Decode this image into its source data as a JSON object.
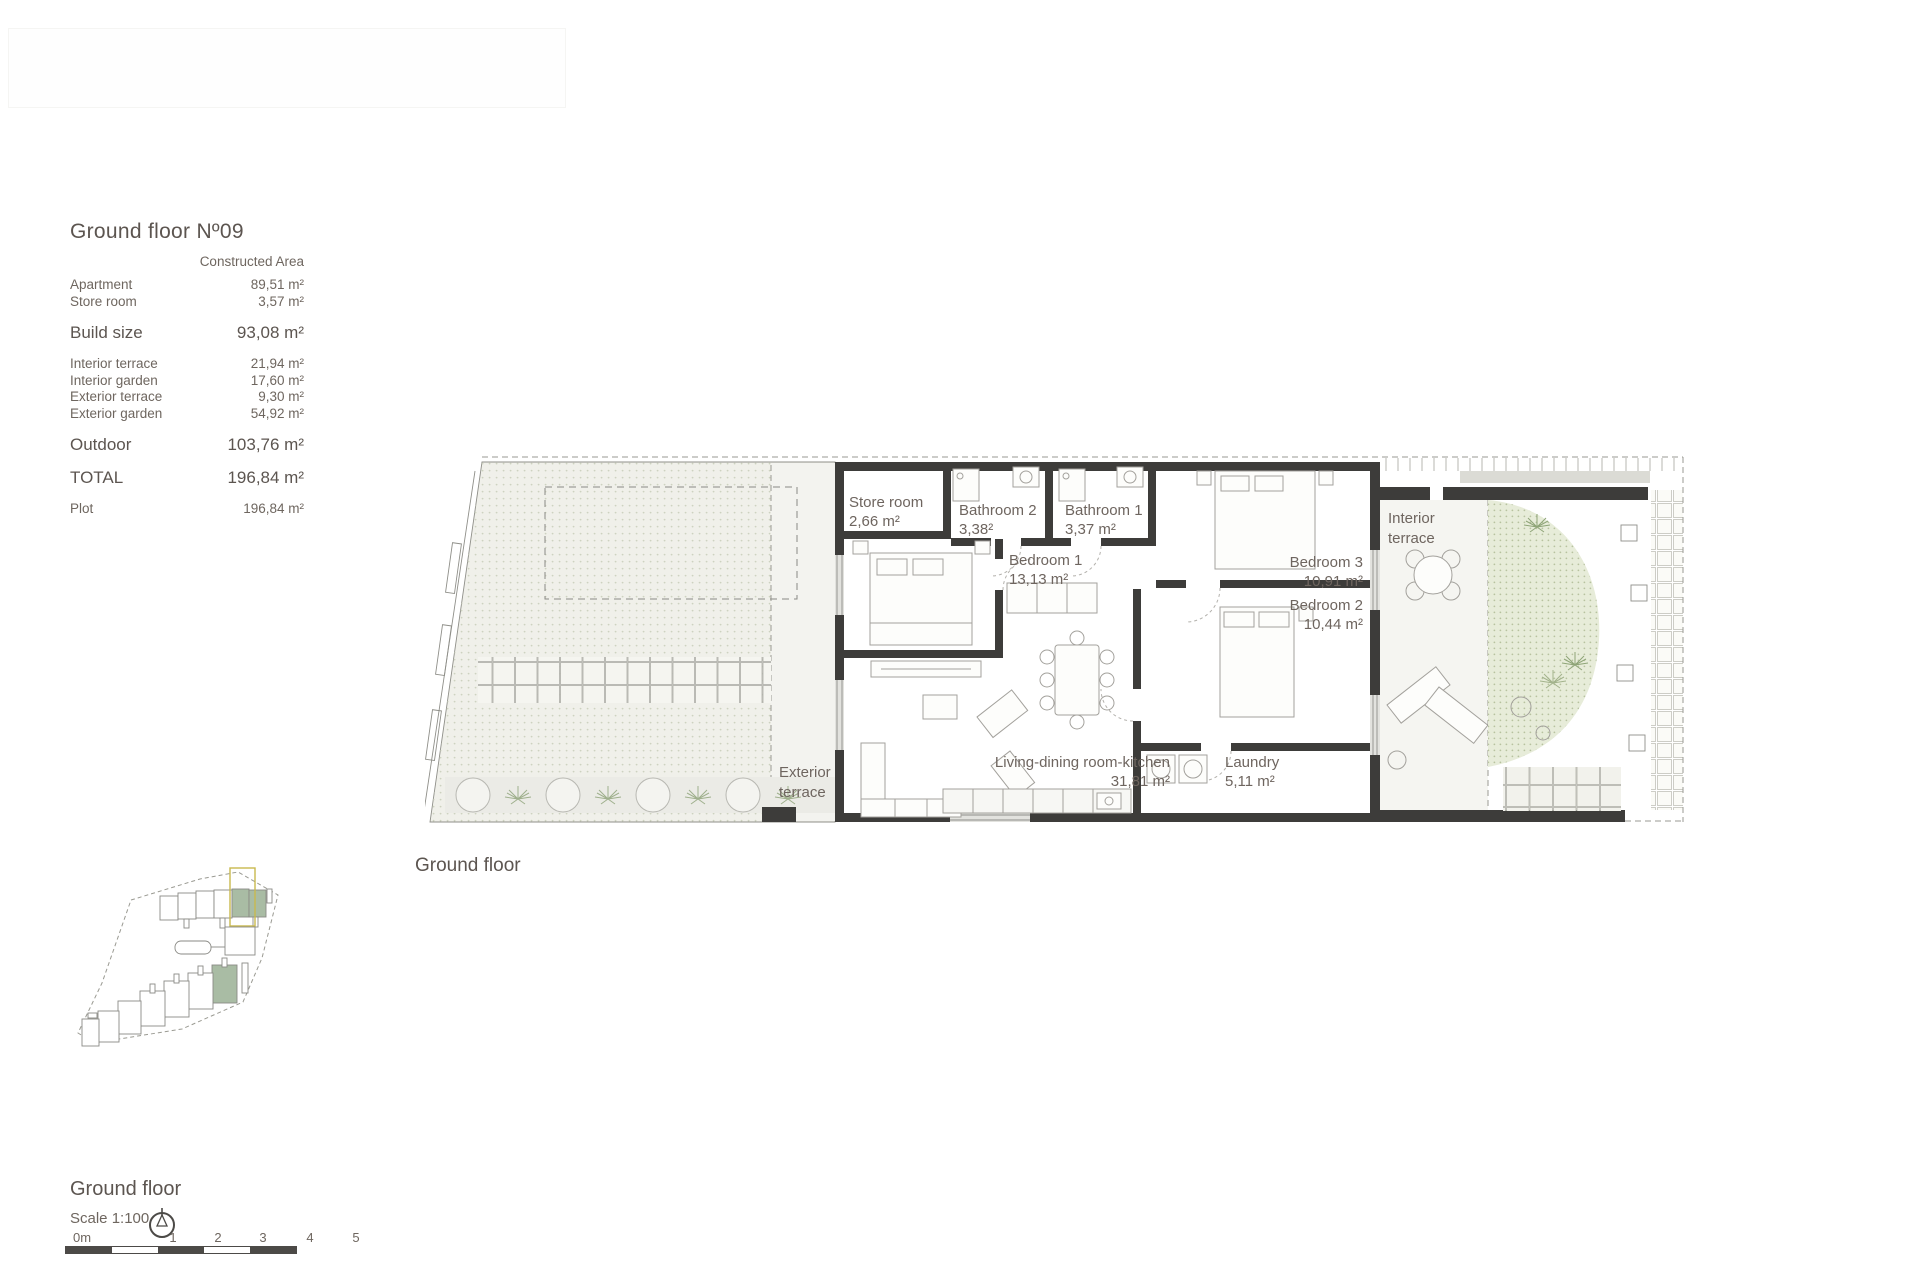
{
  "area_table": {
    "title": "Ground floor Nº09",
    "column_header": "Constructed Area",
    "rows": [
      {
        "label": "Apartment",
        "value": "89,51 m²"
      },
      {
        "label": "Store room",
        "value": "3,57 m²"
      },
      {
        "label": "Build size",
        "value": "93,08 m²"
      },
      {
        "label": "Interior terrace",
        "value": "21,94 m²"
      },
      {
        "label": "Interior garden",
        "value": "17,60 m²"
      },
      {
        "label": "Exterior terrace",
        "value": "9,30 m²"
      },
      {
        "label": "Exterior garden",
        "value": "54,92 m²"
      },
      {
        "label": "Outdoor",
        "value": "103,76 m²"
      },
      {
        "label": "TOTAL",
        "value": "196,84 m²"
      },
      {
        "label": "Plot",
        "value": "196,84 m²"
      }
    ]
  },
  "floor_plan": {
    "caption": "Ground floor",
    "labels": {
      "store_room": {
        "name": "Store room",
        "area": "2,66 m²"
      },
      "bathroom2": {
        "name": "Bathroom 2",
        "area": "3,38²"
      },
      "bathroom1": {
        "name": "Bathroom 1",
        "area": "3,37 m²"
      },
      "bedroom1": {
        "name": "Bedroom 1",
        "area": "13,13 m²"
      },
      "bedroom3": {
        "name": "Bedroom 3",
        "area": "10,91 m²"
      },
      "bedroom2": {
        "name": "Bedroom 2",
        "area": "10,44 m²"
      },
      "living": {
        "name": "Living-dining room-kitchen",
        "area": "31,81 m²"
      },
      "laundry": {
        "name": "Laundry",
        "area": "5,11 m²"
      },
      "interior_terrace": {
        "line1": "Interior",
        "line2": "terrace"
      },
      "exterior_terrace": {
        "line1": "Exterior",
        "line2": "terrace"
      }
    }
  },
  "legend": {
    "title": "Ground floor",
    "scale": "Scale 1:100",
    "scale_ticks": [
      "0m",
      "1",
      "2",
      "3",
      "4",
      "5"
    ]
  },
  "colors": {
    "wall": "#3d3c3a",
    "text": "#675f59",
    "unit_highlight_green": "#a9bca4",
    "unit_highlight_yellow": "#c9b94e"
  }
}
